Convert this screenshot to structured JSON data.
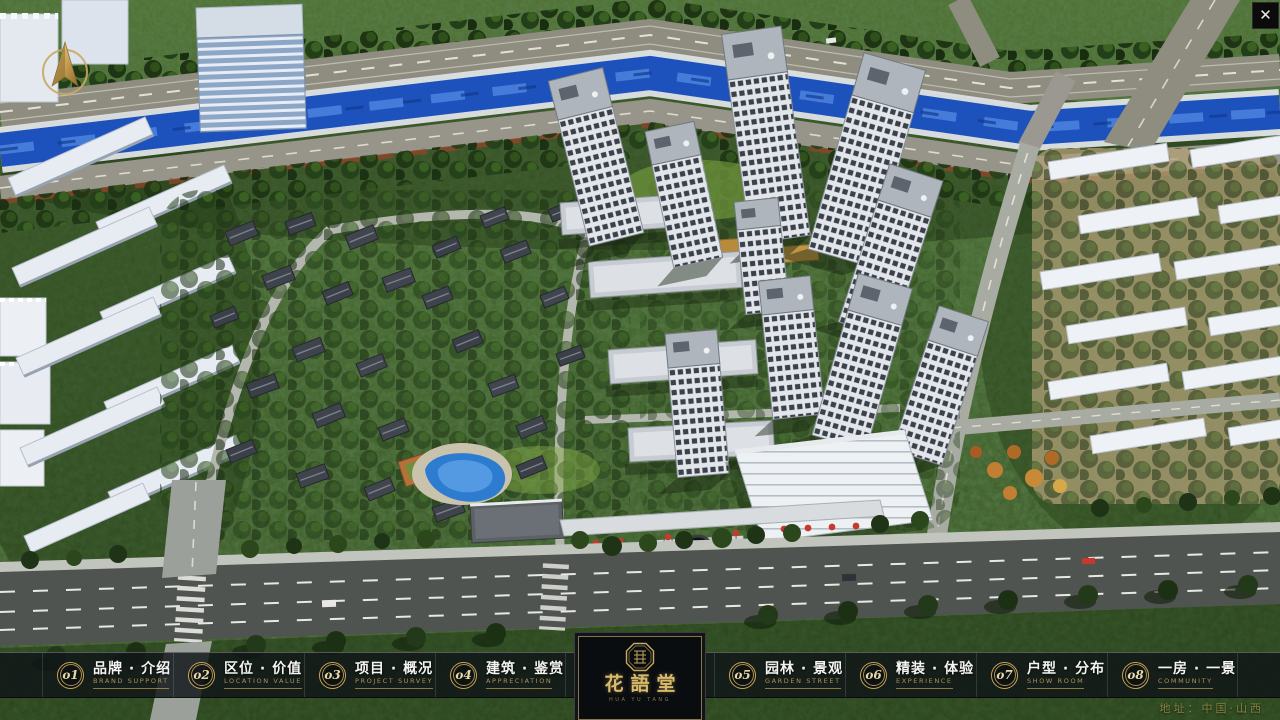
{
  "window": {
    "close_icon": "✕"
  },
  "nav": {
    "items": [
      {
        "num": "o1",
        "label": "品牌 · 介绍",
        "sublabel": "BRAND SUPPORT"
      },
      {
        "num": "o2",
        "label": "区位 · 价值",
        "sublabel": "LOCATION VALUE"
      },
      {
        "num": "o3",
        "label": "项目 · 概况",
        "sublabel": "PROJECT SURVEY"
      },
      {
        "num": "o4",
        "label": "建筑 · 鉴赏",
        "sublabel": "APPRECIATION"
      },
      {
        "num": "o5",
        "label": "园林 · 景观",
        "sublabel": "GARDEN STREET"
      },
      {
        "num": "o6",
        "label": "精装 · 体验",
        "sublabel": "EXPERIENCE"
      },
      {
        "num": "o7",
        "label": "户型 · 分布",
        "sublabel": "SHOW ROOM"
      },
      {
        "num": "o8",
        "label": "一房 · 一景",
        "sublabel": "COMMUNITY"
      }
    ]
  },
  "logo": {
    "name": "花語堂",
    "caption": "HUA YU TANG"
  },
  "footer": {
    "address": "地址：中国·山西"
  },
  "colors": {
    "accent_gold": "#c9a659",
    "bar_background": "#0f1317",
    "river_blue": "#1d52bd",
    "canopy_green": "#33511f"
  }
}
